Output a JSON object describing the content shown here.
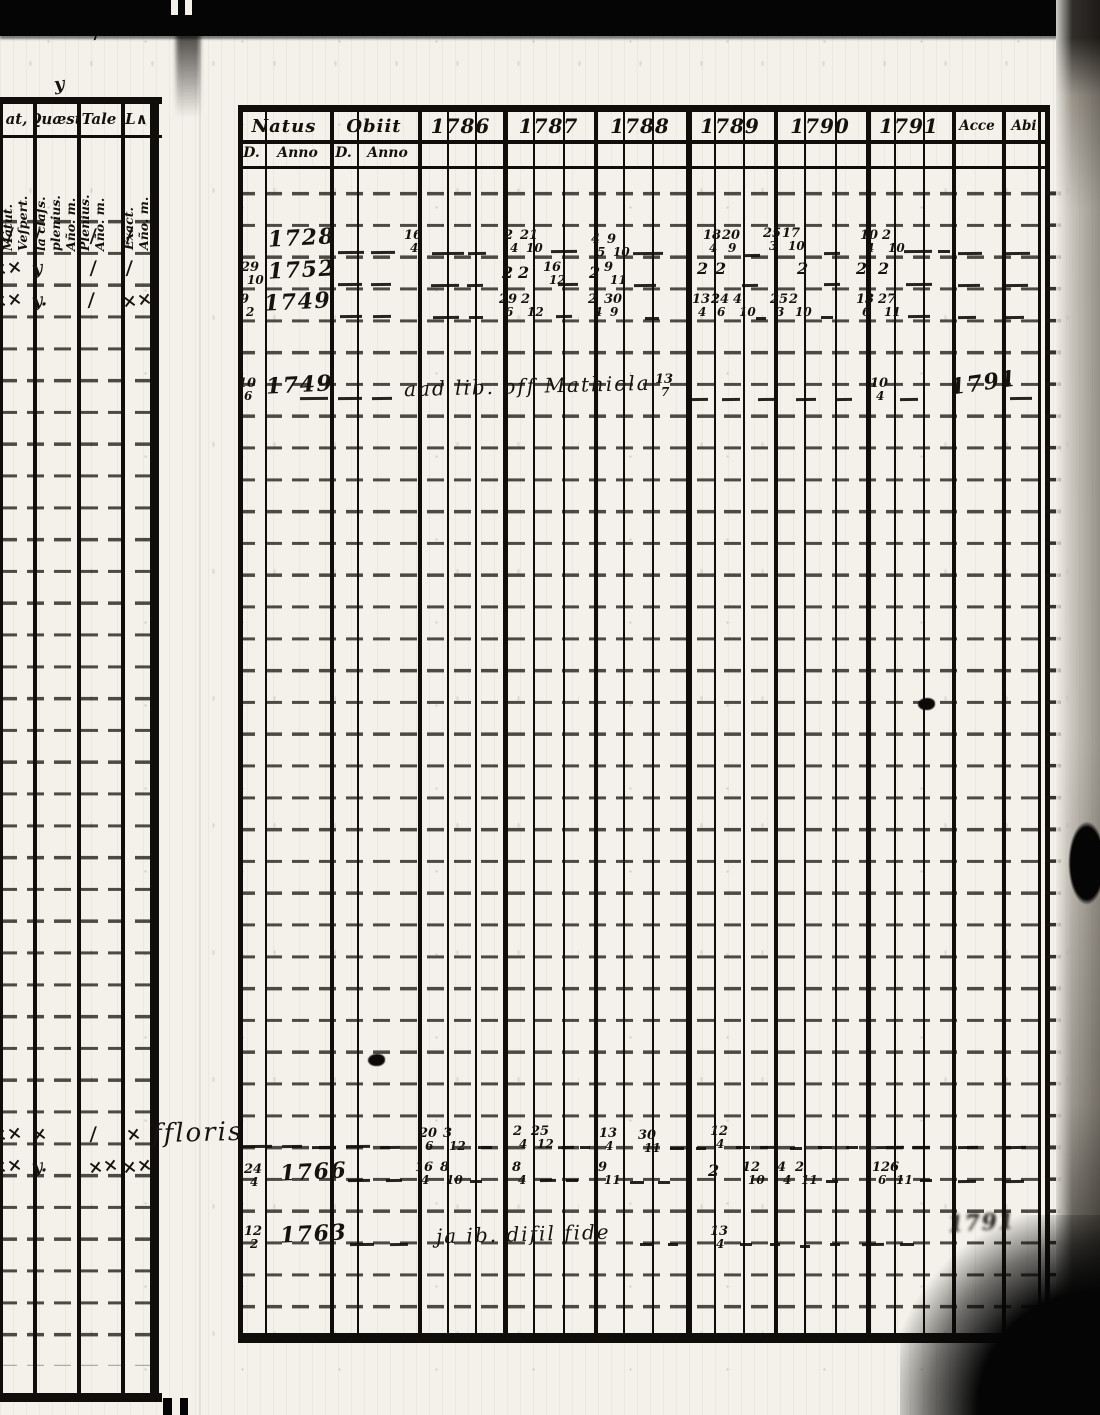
{
  "left_page": {
    "col_headers": [
      {
        "top": "at,",
        "side": "Matut.\nVeſpert."
      },
      {
        "top": "Quæst",
        "side": "la claſs.\nplenius.\nAño. m."
      },
      {
        "top": "Tale",
        "side": "Plenius.\nAño. m."
      },
      {
        "top": "L∧",
        "side": "Exact.\nAño. m."
      }
    ]
  },
  "main_table": {
    "columns": [
      "Natus",
      "Obiit",
      "1786",
      "1787",
      "1788",
      "1789",
      "1790",
      "1791",
      "Acce",
      "Abi"
    ],
    "subheaders": [
      "D.",
      "Anno",
      "D.",
      "Anno"
    ]
  },
  "annotations": [
    {
      "x": 54,
      "y": 74,
      "cls": "mark",
      "text": "y"
    },
    {
      "x": 94,
      "y": 22,
      "cls": "mark",
      "text": "/"
    },
    {
      "x": -8,
      "y": 226,
      "cls": "mark",
      "text": "×/"
    },
    {
      "x": 34,
      "y": 226,
      "cls": "mark",
      "text": "/"
    },
    {
      "x": 90,
      "y": 226,
      "cls": "mark",
      "text": "/"
    },
    {
      "x": 126,
      "y": 226,
      "cls": "mark",
      "text": "/"
    },
    {
      "x": -8,
      "y": 258,
      "cls": "mark",
      "text": "××"
    },
    {
      "x": 32,
      "y": 258,
      "cls": "mark",
      "text": "y"
    },
    {
      "x": 90,
      "y": 258,
      "cls": "mark",
      "text": "/"
    },
    {
      "x": 126,
      "y": 258,
      "cls": "mark",
      "text": "/"
    },
    {
      "x": -8,
      "y": 290,
      "cls": "mark",
      "text": "××"
    },
    {
      "x": 32,
      "y": 290,
      "cls": "mark",
      "text": "y."
    },
    {
      "x": 88,
      "y": 290,
      "cls": "mark",
      "text": "/"
    },
    {
      "x": 122,
      "y": 290,
      "cls": "mark",
      "text": "××"
    },
    {
      "x": -8,
      "y": 1124,
      "cls": "mark",
      "text": "××"
    },
    {
      "x": 32,
      "y": 1124,
      "cls": "mark",
      "text": "×"
    },
    {
      "x": 90,
      "y": 1124,
      "cls": "mark",
      "text": "/"
    },
    {
      "x": 126,
      "y": 1124,
      "cls": "mark",
      "text": "×"
    },
    {
      "x": -8,
      "y": 1156,
      "cls": "mark",
      "text": "××"
    },
    {
      "x": 32,
      "y": 1156,
      "cls": "mark",
      "text": "y."
    },
    {
      "x": 88,
      "y": 1156,
      "cls": "mark",
      "text": "××"
    },
    {
      "x": 122,
      "y": 1156,
      "cls": "mark",
      "text": "××"
    },
    {
      "x": 268,
      "y": 225,
      "cls": "yr",
      "text": "1728"
    },
    {
      "x": 404,
      "y": 231,
      "cls": "fr",
      "top": "16",
      "bot": "4"
    },
    {
      "x": 504,
      "y": 231,
      "cls": "fr",
      "top": "2",
      "bot": "4"
    },
    {
      "x": 520,
      "y": 231,
      "cls": "fr",
      "top": "21",
      "bot": "10"
    },
    {
      "x": 591,
      "y": 235,
      "cls": "fr",
      "top": "4",
      "bot": "5"
    },
    {
      "x": 607,
      "y": 235,
      "cls": "fr",
      "top": "9",
      "bot": "10"
    },
    {
      "x": 703,
      "y": 231,
      "cls": "fr",
      "top": "18",
      "bot": "4"
    },
    {
      "x": 722,
      "y": 231,
      "cls": "fr",
      "top": "20",
      "bot": "9"
    },
    {
      "x": 763,
      "y": 229,
      "cls": "fr",
      "top": "25",
      "bot": "3"
    },
    {
      "x": 782,
      "y": 229,
      "cls": "fr",
      "top": "17",
      "bot": "10"
    },
    {
      "x": 860,
      "y": 231,
      "cls": "fr",
      "top": "10",
      "bot": "4"
    },
    {
      "x": 882,
      "y": 231,
      "cls": "fr",
      "top": "2",
      "bot": "10"
    },
    {
      "x": 338,
      "y": 251,
      "w": 26
    },
    {
      "x": 371,
      "y": 251,
      "w": 24
    },
    {
      "x": 432,
      "y": 252,
      "w": 32
    },
    {
      "x": 468,
      "y": 252,
      "w": 18
    },
    {
      "x": 551,
      "y": 250,
      "w": 26
    },
    {
      "x": 633,
      "y": 252,
      "w": 30
    },
    {
      "x": 744,
      "y": 254,
      "w": 16
    },
    {
      "x": 824,
      "y": 252,
      "w": 16
    },
    {
      "x": 904,
      "y": 250,
      "w": 28
    },
    {
      "x": 938,
      "y": 250,
      "w": 12
    },
    {
      "x": 958,
      "y": 252,
      "w": 24
    },
    {
      "x": 1006,
      "y": 252,
      "w": 24
    },
    {
      "x": 241,
      "y": 263,
      "cls": "fr",
      "top": "29",
      "bot": "10"
    },
    {
      "x": 268,
      "y": 257,
      "cls": "yr",
      "text": "1752"
    },
    {
      "x": 502,
      "y": 263,
      "cls": "num",
      "text": "2"
    },
    {
      "x": 518,
      "y": 263,
      "cls": "num",
      "text": "2"
    },
    {
      "x": 543,
      "y": 263,
      "cls": "fr",
      "top": "16",
      "bot": "12"
    },
    {
      "x": 589,
      "y": 263,
      "cls": "num",
      "text": "2"
    },
    {
      "x": 604,
      "y": 263,
      "cls": "fr",
      "top": "9",
      "bot": "11"
    },
    {
      "x": 697,
      "y": 259,
      "cls": "num",
      "text": "2"
    },
    {
      "x": 715,
      "y": 259,
      "cls": "num",
      "text": "2"
    },
    {
      "x": 797,
      "y": 259,
      "cls": "num",
      "text": "2"
    },
    {
      "x": 856,
      "y": 259,
      "cls": "num",
      "text": "2"
    },
    {
      "x": 878,
      "y": 259,
      "cls": "num",
      "text": "2"
    },
    {
      "x": 338,
      "y": 283,
      "w": 24
    },
    {
      "x": 371,
      "y": 283,
      "w": 20
    },
    {
      "x": 431,
      "y": 284,
      "w": 28
    },
    {
      "x": 467,
      "y": 284,
      "w": 16
    },
    {
      "x": 558,
      "y": 283,
      "w": 20
    },
    {
      "x": 634,
      "y": 284,
      "w": 22
    },
    {
      "x": 742,
      "y": 284,
      "w": 16
    },
    {
      "x": 824,
      "y": 283,
      "w": 16
    },
    {
      "x": 906,
      "y": 283,
      "w": 26
    },
    {
      "x": 958,
      "y": 284,
      "w": 22
    },
    {
      "x": 1006,
      "y": 284,
      "w": 22
    },
    {
      "x": 240,
      "y": 295,
      "cls": "fr",
      "top": "9",
      "bot": "2"
    },
    {
      "x": 264,
      "y": 289,
      "cls": "yr",
      "text": "1749"
    },
    {
      "x": 499,
      "y": 295,
      "cls": "fr",
      "top": "29",
      "bot": "6"
    },
    {
      "x": 521,
      "y": 295,
      "cls": "fr",
      "top": "2",
      "bot": "12"
    },
    {
      "x": 588,
      "y": 295,
      "cls": "fr",
      "top": "2",
      "bot": "4"
    },
    {
      "x": 604,
      "y": 295,
      "cls": "fr",
      "top": "30",
      "bot": "9"
    },
    {
      "x": 692,
      "y": 295,
      "cls": "fr",
      "top": "13",
      "bot": "4"
    },
    {
      "x": 711,
      "y": 295,
      "cls": "fr",
      "top": "24",
      "bot": "6"
    },
    {
      "x": 733,
      "y": 295,
      "cls": "fr",
      "top": "4",
      "bot": "10"
    },
    {
      "x": 770,
      "y": 295,
      "cls": "fr",
      "top": "25",
      "bot": "3"
    },
    {
      "x": 789,
      "y": 295,
      "cls": "fr",
      "top": "2",
      "bot": "10"
    },
    {
      "x": 856,
      "y": 295,
      "cls": "fr",
      "top": "13",
      "bot": "6"
    },
    {
      "x": 878,
      "y": 295,
      "cls": "fr",
      "top": "27",
      "bot": "11"
    },
    {
      "x": 340,
      "y": 315,
      "w": 22
    },
    {
      "x": 373,
      "y": 315,
      "w": 18
    },
    {
      "x": 433,
      "y": 316,
      "w": 26
    },
    {
      "x": 469,
      "y": 316,
      "w": 14
    },
    {
      "x": 556,
      "y": 315,
      "w": 16
    },
    {
      "x": 645,
      "y": 317,
      "w": 14
    },
    {
      "x": 756,
      "y": 317,
      "w": 10
    },
    {
      "x": 821,
      "y": 316,
      "w": 12
    },
    {
      "x": 908,
      "y": 315,
      "w": 22
    },
    {
      "x": 958,
      "y": 316,
      "w": 18
    },
    {
      "x": 1006,
      "y": 316,
      "w": 18
    },
    {
      "x": 238,
      "y": 379,
      "cls": "fr",
      "top": "10",
      "bot": "6"
    },
    {
      "x": 266,
      "y": 372,
      "cls": "yr",
      "text": "1749"
    },
    {
      "x": 404,
      "y": 374,
      "cls": "script",
      "text": "aad lib. off Mathiola"
    },
    {
      "x": 655,
      "y": 375,
      "cls": "fr",
      "top": "13",
      "bot": "7"
    },
    {
      "x": 870,
      "y": 379,
      "cls": "fr",
      "top": "10",
      "bot": "4"
    },
    {
      "x": 950,
      "y": 370,
      "cls": "yr slant",
      "text": "1791"
    },
    {
      "x": 300,
      "y": 397,
      "w": 28
    },
    {
      "x": 338,
      "y": 397,
      "w": 24
    },
    {
      "x": 372,
      "y": 397,
      "w": 20
    },
    {
      "x": 688,
      "y": 398,
      "w": 20
    },
    {
      "x": 722,
      "y": 398,
      "w": 18
    },
    {
      "x": 758,
      "y": 398,
      "w": 18
    },
    {
      "x": 796,
      "y": 398,
      "w": 20
    },
    {
      "x": 836,
      "y": 398,
      "w": 16
    },
    {
      "x": 900,
      "y": 398,
      "w": 18
    },
    {
      "x": 1010,
      "y": 397,
      "w": 22
    },
    {
      "x": 368,
      "y": 1054,
      "cls": "blot"
    },
    {
      "x": 918,
      "y": 698,
      "cls": "blot"
    },
    {
      "x": 152,
      "y": 1118,
      "cls": "script big",
      "text": "ffloris"
    },
    {
      "x": 240,
      "y": 1145,
      "w": 32
    },
    {
      "x": 282,
      "y": 1145,
      "w": 20
    },
    {
      "x": 312,
      "y": 1146,
      "w": 24
    },
    {
      "x": 346,
      "y": 1145,
      "w": 24
    },
    {
      "x": 380,
      "y": 1146,
      "w": 20
    },
    {
      "x": 419,
      "y": 1129,
      "cls": "fr",
      "top": "20",
      "bot": "6"
    },
    {
      "x": 443,
      "y": 1129,
      "cls": "fr",
      "top": "3",
      "bot": "12"
    },
    {
      "x": 478,
      "y": 1146,
      "w": 14
    },
    {
      "x": 513,
      "y": 1127,
      "cls": "fr",
      "top": "2",
      "bot": "4"
    },
    {
      "x": 531,
      "y": 1127,
      "cls": "fr",
      "top": "25",
      "bot": "12"
    },
    {
      "x": 558,
      "y": 1146,
      "w": 16
    },
    {
      "x": 580,
      "y": 1146,
      "w": 10
    },
    {
      "x": 599,
      "y": 1129,
      "cls": "fr",
      "top": "13",
      "bot": "4"
    },
    {
      "x": 638,
      "y": 1131,
      "cls": "fr",
      "top": "30",
      "bot": "11"
    },
    {
      "x": 670,
      "y": 1147,
      "w": 14
    },
    {
      "x": 696,
      "y": 1147,
      "w": 10
    },
    {
      "x": 710,
      "y": 1127,
      "cls": "fr",
      "top": "12",
      "bot": "4"
    },
    {
      "x": 736,
      "y": 1146,
      "w": 14
    },
    {
      "x": 760,
      "y": 1146,
      "w": 16
    },
    {
      "x": 790,
      "y": 1147,
      "w": 12
    },
    {
      "x": 818,
      "y": 1146,
      "w": 14
    },
    {
      "x": 846,
      "y": 1146,
      "w": 12
    },
    {
      "x": 876,
      "y": 1146,
      "w": 28
    },
    {
      "x": 912,
      "y": 1146,
      "w": 18
    },
    {
      "x": 958,
      "y": 1146,
      "w": 20
    },
    {
      "x": 1006,
      "y": 1146,
      "w": 20
    },
    {
      "x": 244,
      "y": 1165,
      "cls": "fr",
      "top": "24",
      "bot": "4"
    },
    {
      "x": 280,
      "y": 1159,
      "cls": "yr",
      "text": "1766"
    },
    {
      "x": 348,
      "y": 1179,
      "w": 22
    },
    {
      "x": 386,
      "y": 1179,
      "w": 16
    },
    {
      "x": 415,
      "y": 1163,
      "cls": "fr",
      "top": "16",
      "bot": "4"
    },
    {
      "x": 440,
      "y": 1163,
      "cls": "fr",
      "top": "8",
      "bot": "10"
    },
    {
      "x": 470,
      "y": 1180,
      "w": 12
    },
    {
      "x": 512,
      "y": 1163,
      "cls": "fr",
      "top": "8",
      "bot": "4"
    },
    {
      "x": 540,
      "y": 1179,
      "w": 16
    },
    {
      "x": 566,
      "y": 1179,
      "w": 12
    },
    {
      "x": 598,
      "y": 1163,
      "cls": "fr",
      "top": "9",
      "bot": "11"
    },
    {
      "x": 630,
      "y": 1181,
      "w": 14
    },
    {
      "x": 658,
      "y": 1181,
      "w": 12
    },
    {
      "x": 708,
      "y": 1161,
      "cls": "num",
      "text": "2"
    },
    {
      "x": 742,
      "y": 1163,
      "cls": "fr",
      "top": "12",
      "bot": "10"
    },
    {
      "x": 777,
      "y": 1163,
      "cls": "fr",
      "top": "4",
      "bot": "4"
    },
    {
      "x": 795,
      "y": 1163,
      "cls": "fr",
      "top": "2",
      "bot": "11"
    },
    {
      "x": 826,
      "y": 1180,
      "w": 12
    },
    {
      "x": 872,
      "y": 1163,
      "cls": "fr",
      "top": "12",
      "bot": "6"
    },
    {
      "x": 890,
      "y": 1163,
      "cls": "fr",
      "top": "6",
      "bot": "11"
    },
    {
      "x": 920,
      "y": 1179,
      "w": 12
    },
    {
      "x": 958,
      "y": 1180,
      "w": 18
    },
    {
      "x": 1006,
      "y": 1180,
      "w": 18
    },
    {
      "x": 244,
      "y": 1227,
      "cls": "fr",
      "top": "12",
      "bot": "2"
    },
    {
      "x": 280,
      "y": 1221,
      "cls": "yr",
      "text": "1763"
    },
    {
      "x": 350,
      "y": 1243,
      "w": 24
    },
    {
      "x": 390,
      "y": 1243,
      "w": 18
    },
    {
      "x": 436,
      "y": 1222,
      "cls": "script",
      "text": "ja ib. difil fide"
    },
    {
      "x": 640,
      "y": 1243,
      "w": 12
    },
    {
      "x": 668,
      "y": 1243,
      "w": 10
    },
    {
      "x": 710,
      "y": 1227,
      "cls": "fr",
      "top": "13",
      "bot": "4"
    },
    {
      "x": 740,
      "y": 1243,
      "w": 12
    },
    {
      "x": 770,
      "y": 1243,
      "w": 10
    },
    {
      "x": 800,
      "y": 1245,
      "w": 10
    },
    {
      "x": 830,
      "y": 1243,
      "w": 10
    },
    {
      "x": 862,
      "y": 1243,
      "w": 22
    },
    {
      "x": 900,
      "y": 1243,
      "w": 14
    },
    {
      "x": 948,
      "y": 1210,
      "cls": "yr smudge",
      "text": "1791"
    }
  ]
}
